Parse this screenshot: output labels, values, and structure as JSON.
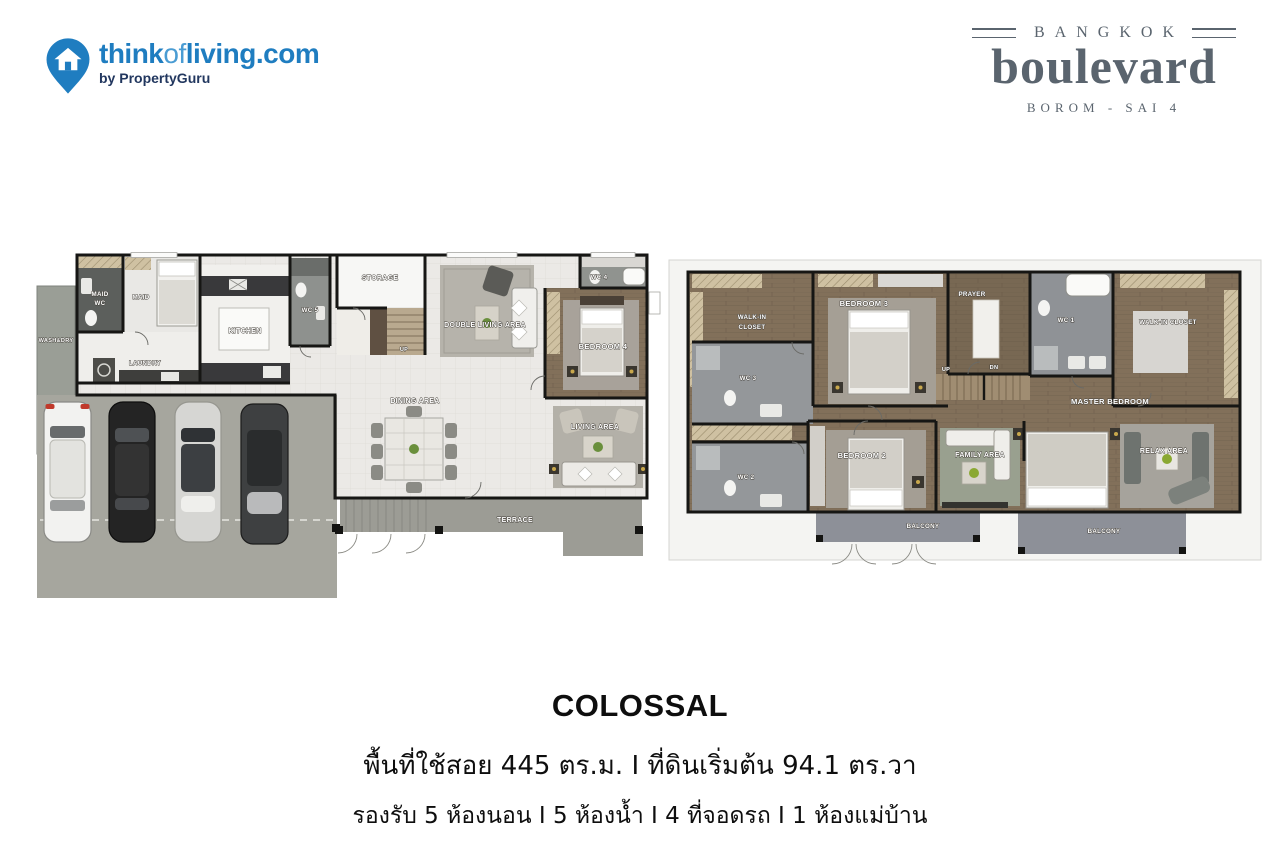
{
  "header": {
    "brand": {
      "think": "think",
      "of": "of",
      "living": "living.com",
      "byline": "by PropertyGuru"
    },
    "project": {
      "city": "BANGKOK",
      "name": "boulevard",
      "location": "BOROM - SAI 4"
    }
  },
  "floor1": {
    "labels": {
      "wash_dry": "WASH&DRY",
      "maid_wc_line1": "MAID",
      "maid_wc_line2": "WC",
      "maid": "MAID",
      "laundry": "LAUNDRY",
      "kitchen": "KITCHEN",
      "wc5": "WC 5",
      "storage": "STORAGE",
      "up": "UP",
      "double_living": "DOUBLE LIVING AREA",
      "wc4": "WC 4",
      "bedroom4": "BEDROOM 4",
      "dining": "DINING AREA",
      "living": "LIVING AREA",
      "terrace": "TERRACE"
    }
  },
  "floor2": {
    "labels": {
      "walkin1_line1": "WALK-IN",
      "walkin1_line2": "CLOSET",
      "bedroom3": "BEDROOM 3",
      "prayer": "PRAYER",
      "wc1": "WC 1",
      "walkin2": "WALK-IN CLOSET",
      "wc3": "WC 3",
      "up": "UP",
      "dn": "DN",
      "master": "MASTER BEDROOM",
      "bedroom2": "BEDROOM 2",
      "wc2": "WC 2",
      "family": "FAMILY AREA",
      "relax": "RELAX AREA",
      "balcony_left": "BALCONY",
      "balcony_right": "BALCONY"
    }
  },
  "footer": {
    "title": "COLOSSAL",
    "area_line": "พื้นที่ใช้สอย 445 ตร.ม. I ที่ดินเริ่มต้น 94.1 ตร.วา",
    "rooms_line": "รองรับ 5 ห้องนอน I 5 ห้องน้ำ I 4 ที่จอดรถ I 1 ห้องแม่บ้าน"
  },
  "colors": {
    "brand_blue": "#1f7dc0",
    "brand_navy": "#22375f",
    "project_slate": "#5a646e",
    "wall_black": "#161614",
    "wood_brown": "#82705a",
    "tile_light": "#ebe9e6",
    "garage_gray": "#a6a69e",
    "terrace_gray": "#9c9c95",
    "balcony_gray": "#8d9098",
    "wc_gray": "#94979a",
    "wardrobe_tan": "#cfc1a2",
    "text_black": "#0e0e0e"
  }
}
